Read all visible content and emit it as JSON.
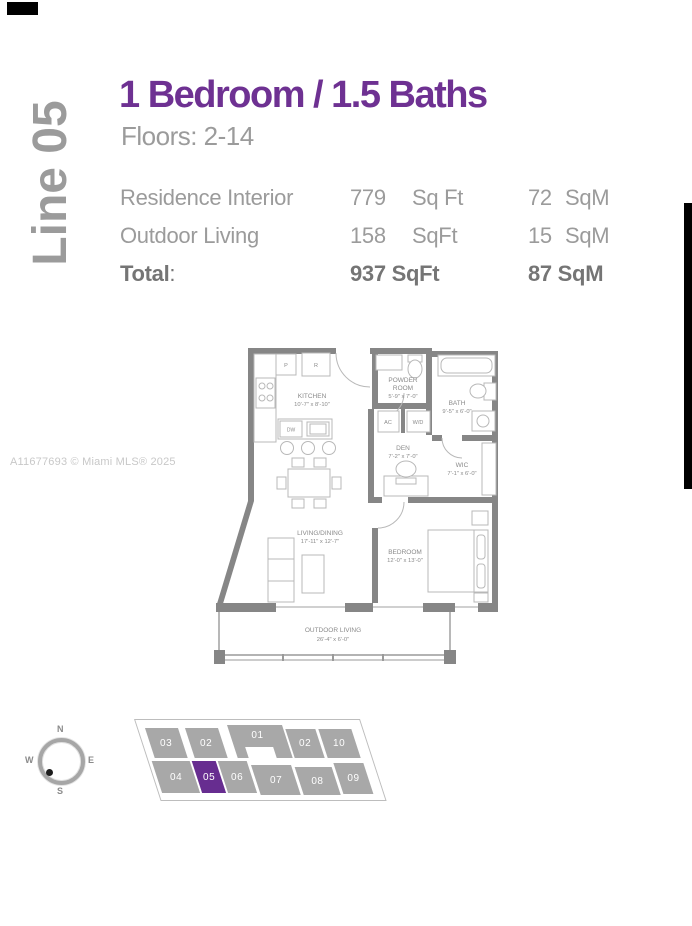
{
  "side_label": "Line 05",
  "watermark": "A11677693 © Miami MLS® 2025",
  "header": {
    "title": "1 Bedroom / 1.5 Baths",
    "floors": "Floors: 2-14",
    "rows": [
      {
        "label": "Residence Interior",
        "sqft_value": "779",
        "sqft_unit": "Sq Ft",
        "sqm_value": "72",
        "sqm_unit": "SqM"
      },
      {
        "label": "Outdoor Living",
        "sqft_value": "158",
        "sqft_unit": "SqFt",
        "sqm_value": "15",
        "sqm_unit": "SqM"
      }
    ],
    "total": {
      "label": "Total",
      "colon": ":",
      "sqft": "937 SqFt",
      "sqm": "87 SqM"
    }
  },
  "floorplan": {
    "rooms": {
      "kitchen": {
        "name": "KITCHEN",
        "dims": "10'-7\" x 8'-10\""
      },
      "powder": {
        "name1": "POWDER",
        "name2": "ROOM",
        "dims": "5'-9\" x 7'-0\""
      },
      "bath": {
        "name": "BATH",
        "dims": "9'-5\" x 6'-0\""
      },
      "den": {
        "name": "DEN",
        "dims": "7'-2\" x 7'-0\""
      },
      "wic": {
        "name": "WIC",
        "dims": "7'-1\" x 6'-0\""
      },
      "living": {
        "name": "LIVING/DINING",
        "dims": "17'-11\" x 12'-7\""
      },
      "bedroom": {
        "name": "BEDROOM",
        "dims": "12'-0\" x 13'-0\""
      },
      "outdoor": {
        "name": "OUTDOOR LIVING",
        "dims": "26'-4\" x 6'-0\""
      }
    },
    "fixtures": {
      "ac": "AC",
      "wd": "W/D",
      "dw": "DW",
      "pantry": "P",
      "fridge": "R"
    }
  },
  "keyplan": {
    "compass": {
      "n": "N",
      "e": "E",
      "s": "S",
      "w": "W"
    },
    "top_row": [
      "03",
      "02",
      "01",
      "02",
      "10"
    ],
    "bottom_row": [
      "04",
      "05",
      "06",
      "07",
      "08",
      "09"
    ],
    "highlighted_unit": "05"
  },
  "colors": {
    "accent_purple": "#6e3192",
    "highlight_purple": "#672d90",
    "keyplan_gray": "#a8a8a8",
    "wall_gray": "#868686",
    "text_gray": "#9b9b9b"
  }
}
